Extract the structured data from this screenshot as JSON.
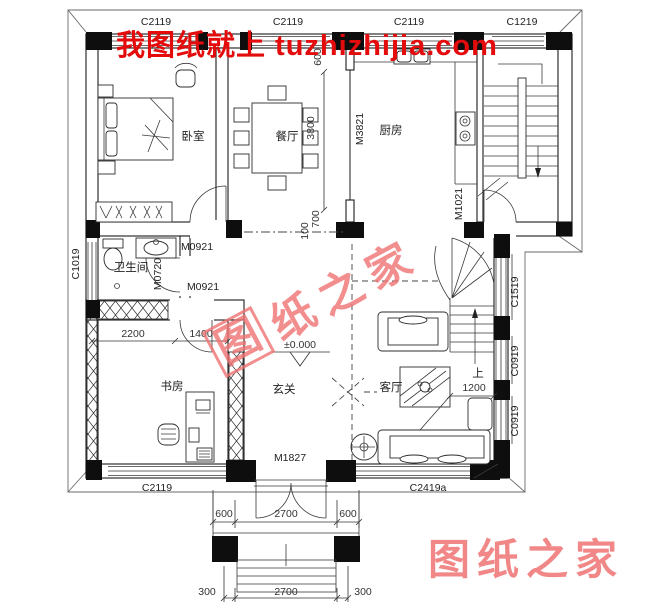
{
  "watermarks": {
    "top_banner": "我图纸就上 tuzhizhijia.com",
    "center_chars": [
      "图",
      "纸",
      "之",
      "家"
    ],
    "bottom_right": "图纸之家",
    "banner_color": "#e30b0b",
    "seal_color": "#ef7373"
  },
  "rooms": {
    "bedroom": "卧室",
    "dining": "餐厅",
    "kitchen": "厨房",
    "bathroom": "卫生间",
    "study": "书房",
    "foyer": "玄关",
    "living": "客厅"
  },
  "openings": {
    "window_c2119": "C2119",
    "window_c1219": "C1219",
    "window_c1019": "C1019",
    "window_c1519": "C1519",
    "window_c0919": "C0919",
    "window_c2419a": "C2419a",
    "door_m0921": "M0921",
    "door_m0720": "M0720",
    "door_m3821": "M3821",
    "door_m1021": "M1021",
    "door_m1827": "M1827"
  },
  "dimensions": {
    "elevation": "±0.000",
    "dining_depth": "3800",
    "top_offset": "600",
    "wall_700": "700",
    "wall_100": "100",
    "study_2200": "2200",
    "study_1400": "1400",
    "stair_1200": "1200",
    "up_label": "上",
    "porch_600_left": "600",
    "porch_2700": "2700",
    "porch_600_right": "600",
    "step_300_left": "300",
    "step_2700": "2700",
    "step_300_right": "300"
  }
}
